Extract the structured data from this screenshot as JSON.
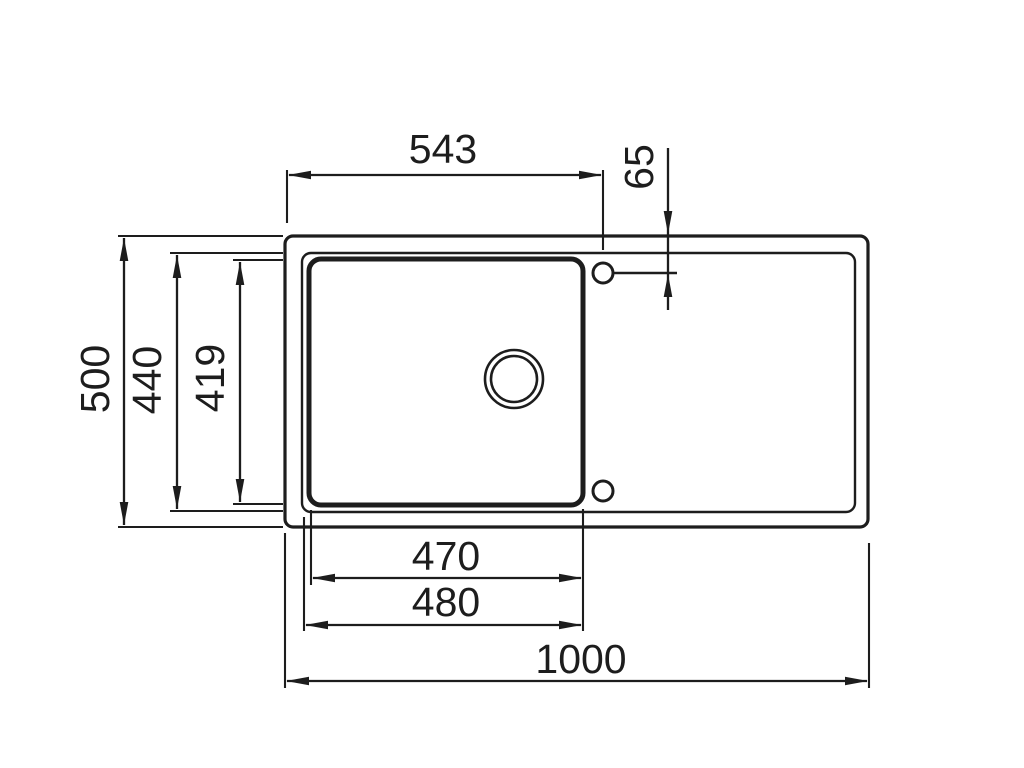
{
  "drawing": {
    "subject": "kitchen-sink-with-drainer-top-view-dimension-drawing",
    "background": "#ffffff",
    "line_color": "#1d1d1d",
    "dims": {
      "top_width": "543",
      "faucet_offset": "65",
      "overall_depth": "500",
      "rim_depth": "440",
      "bowl_depth": "419",
      "bowl_inner_width": "470",
      "bowl_outer_width": "480",
      "overall_width": "1000"
    }
  }
}
